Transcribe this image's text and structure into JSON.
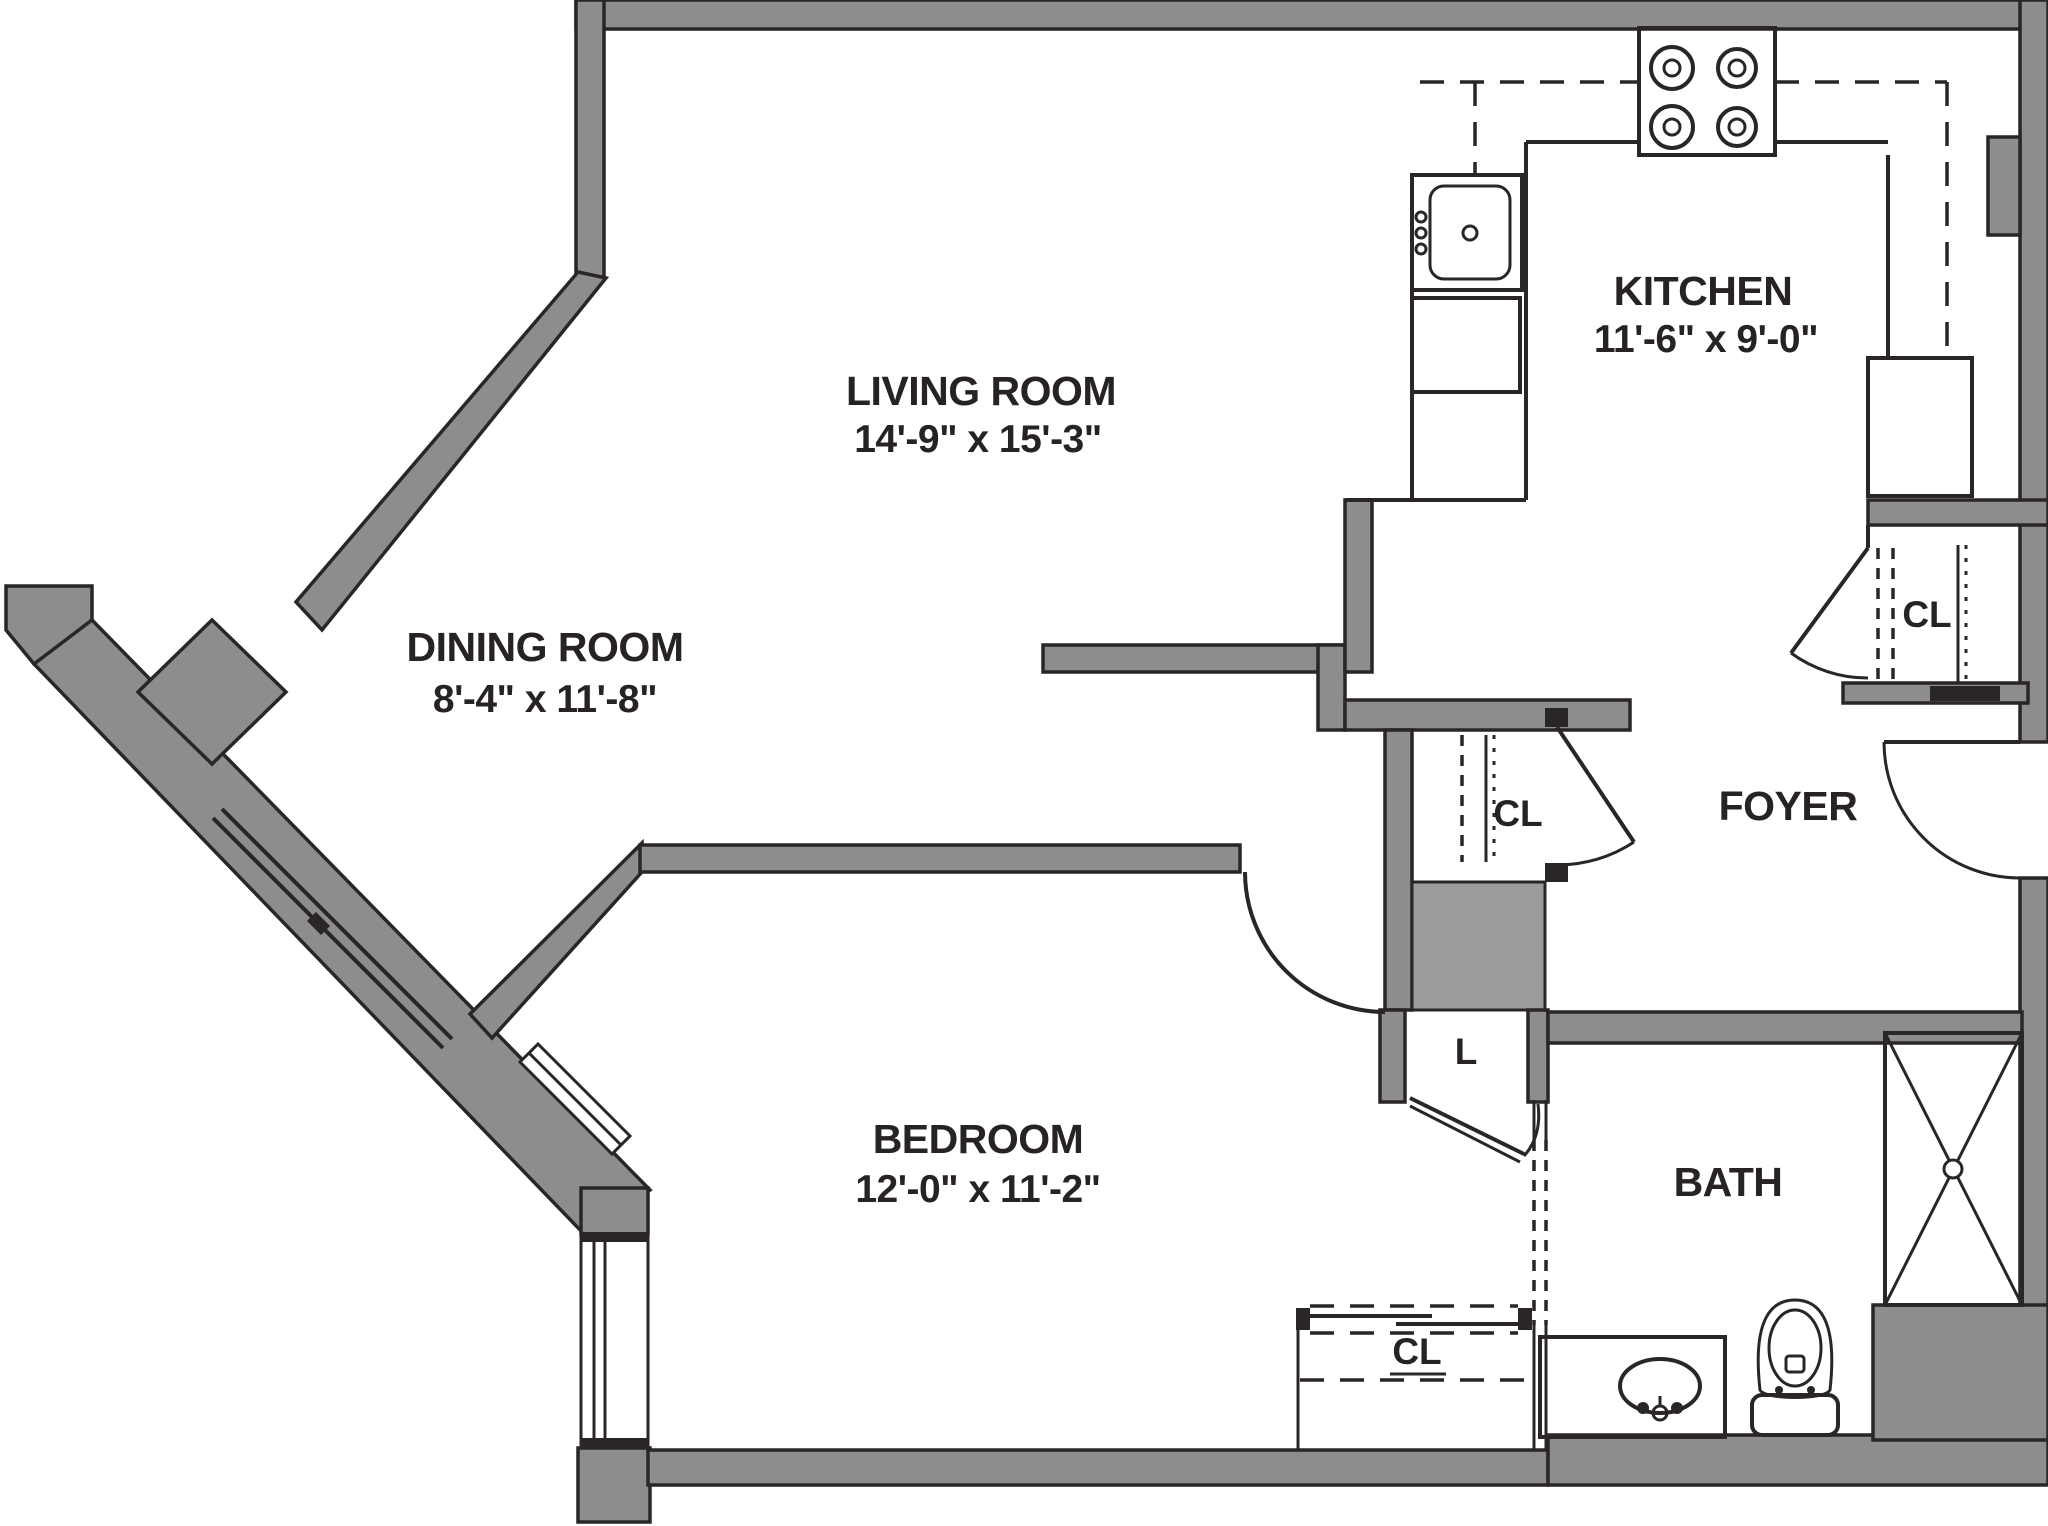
{
  "floorplan": {
    "rooms": [
      {
        "id": "living-room",
        "name": "LIVING ROOM",
        "dims": "14'-9\" x 15'-3\""
      },
      {
        "id": "dining-room",
        "name": "DINING ROOM",
        "dims": "8'-4\" x 11'-8\""
      },
      {
        "id": "kitchen",
        "name": "KITCHEN",
        "dims": "11'-6\" x 9'-0\""
      },
      {
        "id": "bedroom",
        "name": "BEDROOM",
        "dims": "12'-0\" x 11'-2\""
      },
      {
        "id": "foyer",
        "name": "FOYER",
        "dims": ""
      },
      {
        "id": "bath",
        "name": "BATH",
        "dims": ""
      }
    ],
    "closets": [
      {
        "id": "kitchen-closet",
        "label": "CL"
      },
      {
        "id": "hall-closet",
        "label": "CL"
      },
      {
        "id": "linen-closet",
        "label": "L"
      },
      {
        "id": "bedroom-closet",
        "label": "CL"
      }
    ],
    "colors": {
      "wall": "#8d8d8d",
      "wall2": "#9b9b9b",
      "line": "#2a2526",
      "text": "#272223",
      "bg": "#ffffff"
    }
  }
}
